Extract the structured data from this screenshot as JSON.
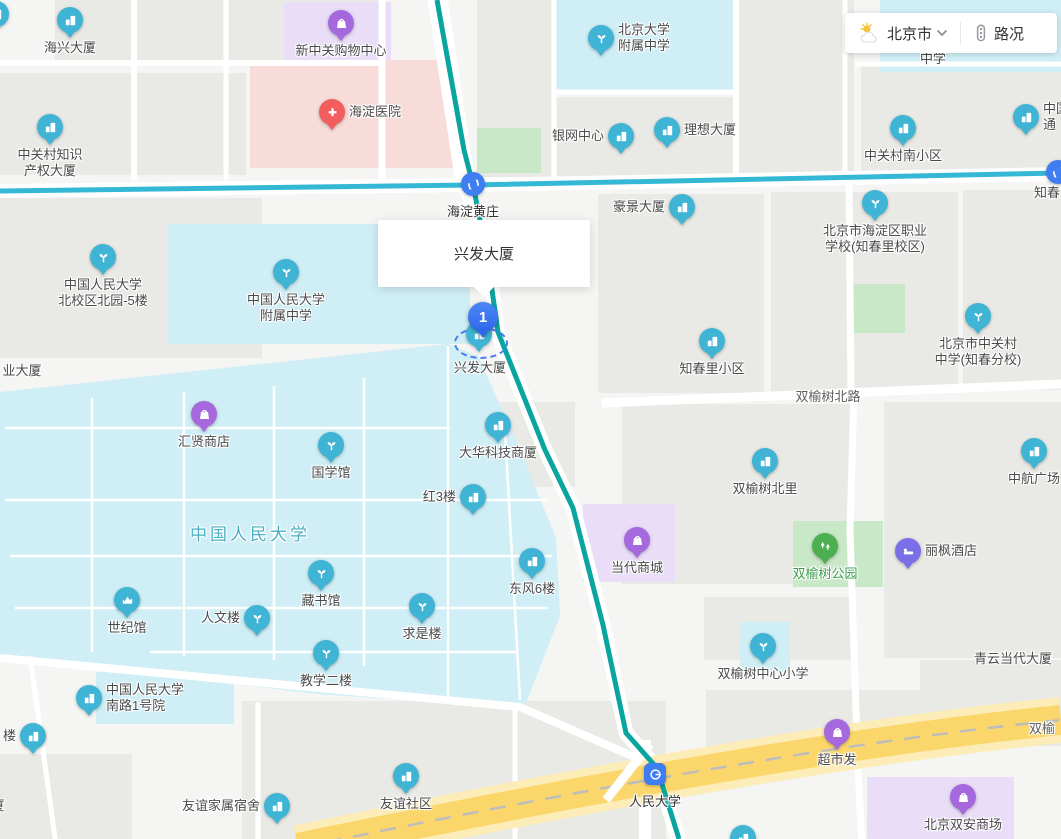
{
  "widget": {
    "city": "北京市",
    "traffic_label": "路况"
  },
  "tooltip": {
    "text": "兴发大厦"
  },
  "marker": {
    "number": "1",
    "label": "兴发大厦"
  },
  "colors": {
    "map_bg": "#f5f5f3",
    "block": "#e9e9e6",
    "campus": "#cfeef6",
    "hospital_area": "#f7dcda",
    "mall_area": "#e9ddf8",
    "park_area": "#c9e8c8",
    "road": "#ffffff",
    "line10": "#35b8d6",
    "line4": "#0ba5a0",
    "highway": "#fbd76b",
    "highway_casing": "#fcecb8",
    "highway_dash": "#bdbdbd",
    "poi_blue": "#3fb4d4",
    "poi_purple": "#a568dd",
    "poi_indigo": "#7b6fe8",
    "poi_green": "#4caf50",
    "poi_red": "#f25d5d",
    "metro_blue": "#3f7df2",
    "marker_blue": "#2f68e8",
    "selection_dash": "#4a7cf0",
    "label_text": "#4a4a4a",
    "road_label_text": "#5f5f5f",
    "area_label_text": "#49aec3",
    "park_label_text": "#3a9e4b"
  },
  "pois": [
    {
      "name": "edge-pin-topleft",
      "type": "building",
      "x": -4,
      "y": 14,
      "lines": [],
      "pos": "none"
    },
    {
      "name": "haixing-daxia",
      "type": "building",
      "x": 70,
      "y": 20,
      "lines": [
        "海兴大厦"
      ],
      "pos": "below"
    },
    {
      "name": "xinzhongguan-mall",
      "type": "shop",
      "x": 341,
      "y": 23,
      "lines": [
        "新中关购物中心"
      ],
      "pos": "below"
    },
    {
      "name": "haidian-hospital",
      "type": "hospital",
      "x": 332,
      "y": 112,
      "lines": [
        "海淀医院"
      ],
      "pos": "right"
    },
    {
      "name": "zgc-ip-tower",
      "type": "building",
      "x": 50,
      "y": 127,
      "lines": [
        "中关村知识",
        "产权大厦"
      ],
      "pos": "below"
    },
    {
      "name": "pku-affiliated-hs",
      "type": "school",
      "x": 601,
      "y": 38,
      "lines": [
        "北京大学",
        "附属中学"
      ],
      "pos": "right"
    },
    {
      "name": "zhongxue-partial",
      "type": "text",
      "x": 933,
      "y": 59,
      "lines": [
        "中学"
      ],
      "pos": "center"
    },
    {
      "name": "yinwang-center",
      "type": "building",
      "x": 621,
      "y": 136,
      "lines": [
        "银网中心"
      ],
      "pos": "left"
    },
    {
      "name": "lixiang-daxia",
      "type": "building",
      "x": 667,
      "y": 130,
      "lines": [
        "理想大厦"
      ],
      "pos": "right"
    },
    {
      "name": "zgc-south-community",
      "type": "building",
      "x": 903,
      "y": 128,
      "lines": [
        "中关村南小区"
      ],
      "pos": "below"
    },
    {
      "name": "edge-building-topright",
      "type": "building",
      "x": 1026,
      "y": 117,
      "lines": [
        "中国",
        "通"
      ],
      "pos": "right"
    },
    {
      "name": "haidianhuangzhuang-station",
      "type": "metro-interchange",
      "x": 473,
      "y": 184,
      "lines": [
        "海淀黄庄"
      ],
      "pos": "below",
      "cls": "station"
    },
    {
      "name": "haojing-daxia",
      "type": "building",
      "x": 682,
      "y": 207,
      "lines": [
        "豪景大厦"
      ],
      "pos": "left"
    },
    {
      "name": "haidian-vocational-school",
      "type": "school",
      "x": 875,
      "y": 203,
      "lines": [
        "北京市海淀区职业",
        "学校(知春里校区)"
      ],
      "pos": "below"
    },
    {
      "name": "zhichun-label",
      "type": "text",
      "x": 1047,
      "y": 193,
      "lines": [
        "知春"
      ],
      "pos": "center"
    },
    {
      "name": "edge-station-right",
      "type": "metro-interchange",
      "x": 1058,
      "y": 172,
      "lines": [],
      "pos": "none"
    },
    {
      "name": "ruc-north-campus-5",
      "type": "school",
      "x": 103,
      "y": 257,
      "lines": [
        "中国人民大学",
        "北校区北园-5楼"
      ],
      "pos": "below"
    },
    {
      "name": "ruc-affiliated-hs",
      "type": "school",
      "x": 286,
      "y": 272,
      "lines": [
        "中国人民大学",
        "附属中学"
      ],
      "pos": "below"
    },
    {
      "name": "zhichunli-community",
      "type": "building",
      "x": 712,
      "y": 341,
      "lines": [
        "知春里小区"
      ],
      "pos": "below"
    },
    {
      "name": "zgc-middle-school-zhichun",
      "type": "school",
      "x": 978,
      "y": 316,
      "lines": [
        "北京市中关村",
        "中学(知春分校)"
      ],
      "pos": "below"
    },
    {
      "name": "ye-daxia-partial",
      "type": "text",
      "x": 22,
      "y": 371,
      "lines": [
        "业大厦"
      ],
      "pos": "center"
    },
    {
      "name": "shuangyushu-north-road-label",
      "type": "road",
      "x": 828,
      "y": 397,
      "lines": [
        "双榆树北路"
      ],
      "pos": "center",
      "cls": "road-label"
    },
    {
      "name": "huixian-store",
      "type": "shop",
      "x": 204,
      "y": 414,
      "lines": [
        "汇贤商店"
      ],
      "pos": "below"
    },
    {
      "name": "guoxueguan",
      "type": "school",
      "x": 331,
      "y": 445,
      "lines": [
        "国学馆"
      ],
      "pos": "below"
    },
    {
      "name": "dahua-tech-tower",
      "type": "building",
      "x": 498,
      "y": 425,
      "lines": [
        "大华科技商厦"
      ],
      "pos": "below"
    },
    {
      "name": "hong-3-lou",
      "type": "building",
      "x": 473,
      "y": 497,
      "lines": [
        "红3楼"
      ],
      "pos": "left"
    },
    {
      "name": "shuangyushu-beili",
      "type": "building",
      "x": 765,
      "y": 461,
      "lines": [
        "双榆树北里"
      ],
      "pos": "below"
    },
    {
      "name": "zhonghang-plaza",
      "type": "building",
      "x": 1034,
      "y": 451,
      "lines": [
        "中航广场"
      ],
      "pos": "below"
    },
    {
      "name": "ruc-area-label",
      "type": "area",
      "x": 250,
      "y": 533,
      "lines": [
        "中国人民大学"
      ],
      "pos": "center",
      "cls": "area-label"
    },
    {
      "name": "dangdai-mall",
      "type": "shop",
      "x": 637,
      "y": 540,
      "lines": [
        "当代商城"
      ],
      "pos": "below"
    },
    {
      "name": "shuangyushu-park",
      "type": "park",
      "x": 825,
      "y": 546,
      "lines": [
        "双榆树公园"
      ],
      "pos": "below",
      "cls": "park-label"
    },
    {
      "name": "lifeng-hotel",
      "type": "hotel",
      "x": 908,
      "y": 551,
      "lines": [
        "丽枫酒店"
      ],
      "pos": "right"
    },
    {
      "name": "dongfeng-6-lou",
      "type": "building",
      "x": 532,
      "y": 561,
      "lines": [
        "东风6楼"
      ],
      "pos": "below"
    },
    {
      "name": "cangshuguan",
      "type": "school",
      "x": 321,
      "y": 573,
      "lines": [
        "藏书馆"
      ],
      "pos": "below"
    },
    {
      "name": "shijiguan",
      "type": "stadium",
      "x": 127,
      "y": 600,
      "lines": [
        "世纪馆"
      ],
      "pos": "below"
    },
    {
      "name": "renwenlou",
      "type": "school",
      "x": 257,
      "y": 618,
      "lines": [
        "人文楼"
      ],
      "pos": "left"
    },
    {
      "name": "qiushilou",
      "type": "school",
      "x": 422,
      "y": 606,
      "lines": [
        "求是楼"
      ],
      "pos": "below"
    },
    {
      "name": "sys-central-primary",
      "type": "school",
      "x": 763,
      "y": 646,
      "lines": [
        "双榆树中心小学"
      ],
      "pos": "below"
    },
    {
      "name": "jiaoxue-er-lou",
      "type": "school",
      "x": 326,
      "y": 653,
      "lines": [
        "教学二楼"
      ],
      "pos": "below"
    },
    {
      "name": "qingyun-dangdai-daxia",
      "type": "text",
      "x": 1013,
      "y": 659,
      "lines": [
        "青云当代大厦"
      ],
      "pos": "center"
    },
    {
      "name": "ruc-south-road-1",
      "type": "building",
      "x": 89,
      "y": 698,
      "lines": [
        "中国人民大学",
        "南路1号院"
      ],
      "pos": "right"
    },
    {
      "name": "lou-partial",
      "type": "building",
      "x": 33,
      "y": 736,
      "lines": [
        "楼"
      ],
      "pos": "left"
    },
    {
      "name": "xia-partial",
      "type": "text",
      "x": -2,
      "y": 806,
      "lines": [
        "厦"
      ],
      "pos": "center"
    },
    {
      "name": "youyi-family-dorm",
      "type": "building",
      "x": 277,
      "y": 806,
      "lines": [
        "友谊家属宿舍"
      ],
      "pos": "left"
    },
    {
      "name": "youyi-community",
      "type": "building",
      "x": 406,
      "y": 776,
      "lines": [
        "友谊社区"
      ],
      "pos": "below"
    },
    {
      "name": "renmin-university-station",
      "type": "metro-station",
      "x": 655,
      "y": 774,
      "lines": [
        "人民大学"
      ],
      "pos": "below",
      "cls": "station"
    },
    {
      "name": "chaoshifa",
      "type": "shop",
      "x": 837,
      "y": 732,
      "lines": [
        "超市发"
      ],
      "pos": "below"
    },
    {
      "name": "shuangyu-road-partial",
      "type": "text",
      "x": 1042,
      "y": 729,
      "lines": [
        "双榆"
      ],
      "pos": "center",
      "cls": "road-label"
    },
    {
      "name": "beijing-shuangan-mall",
      "type": "shop",
      "x": 963,
      "y": 797,
      "lines": [
        "北京双安商场"
      ],
      "pos": "below"
    },
    {
      "name": "edge-pin-bottom",
      "type": "building",
      "x": 743,
      "y": 838,
      "lines": [],
      "pos": "none"
    }
  ]
}
